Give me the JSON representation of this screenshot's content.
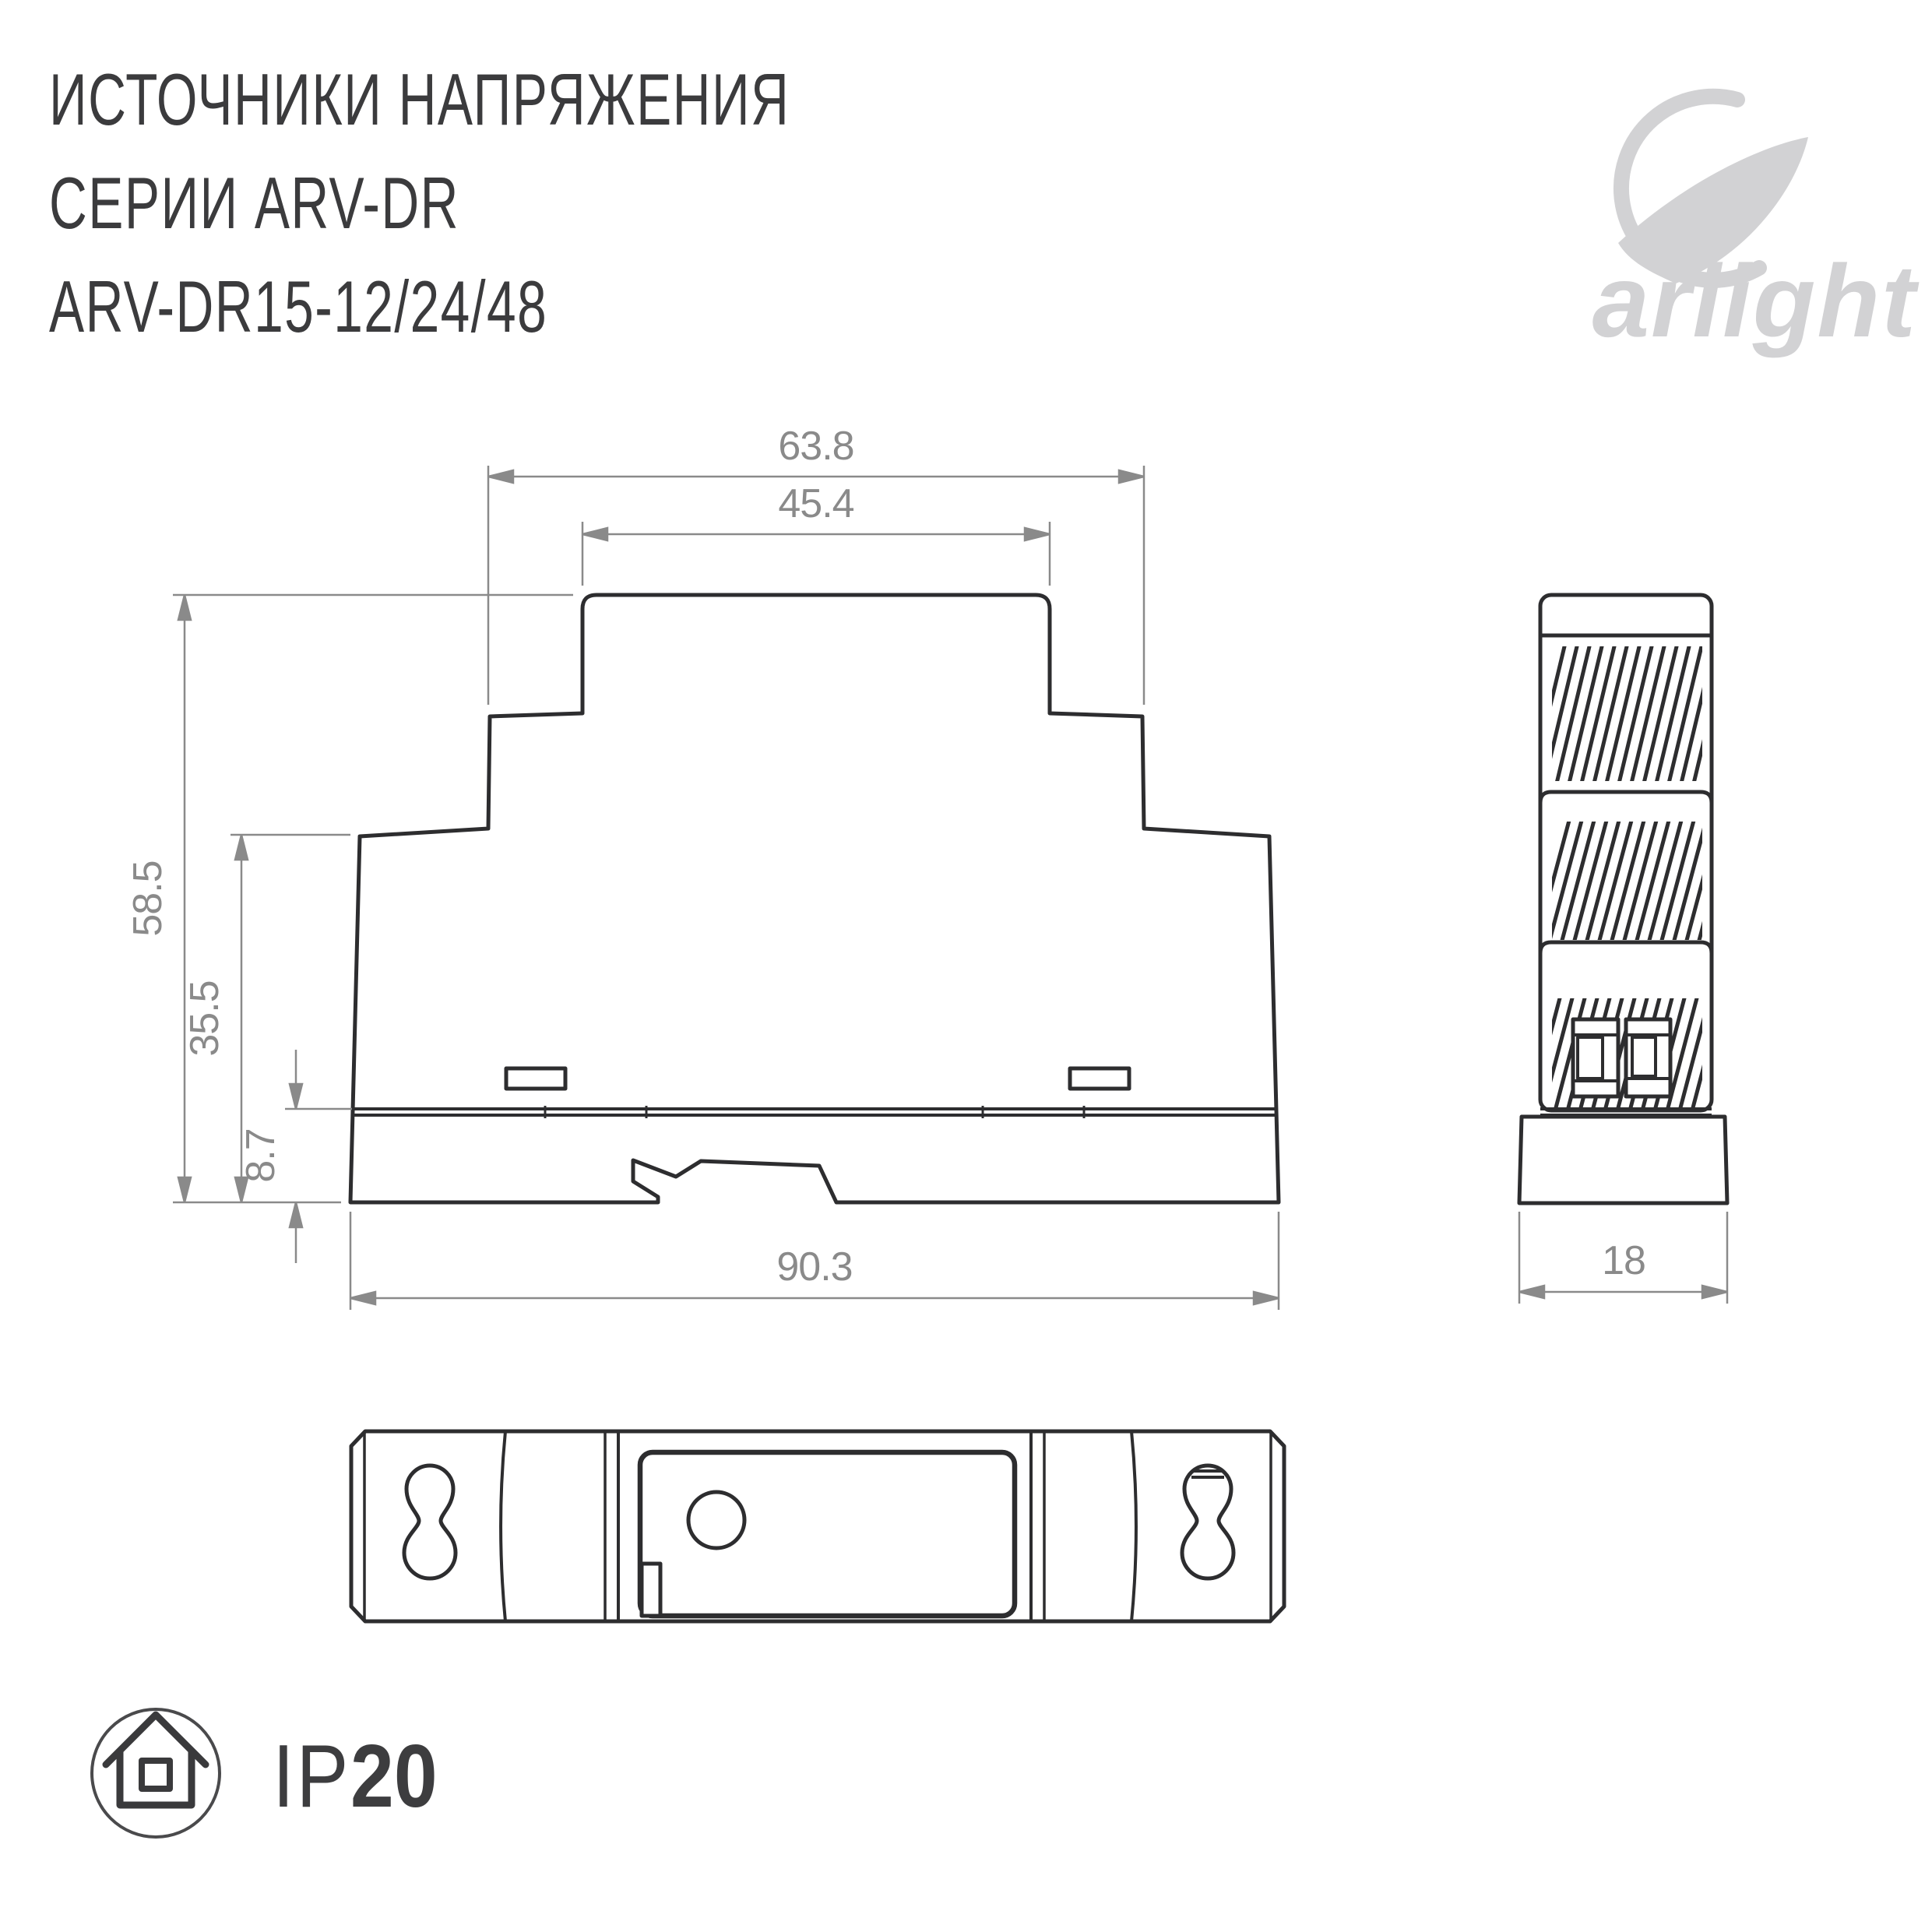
{
  "title": {
    "line1": "ИСТОЧНИКИ НАПРЯЖЕНИЯ",
    "line2": "СЕРИИ ARV-DR",
    "line3": "ARV-DR15-12/24/48"
  },
  "logo": {
    "text": "arlight",
    "color": "#d2d2d4"
  },
  "drawing": {
    "front_view": {
      "dim_top_outer": "63.8",
      "dim_top_inner": "45.4",
      "dim_height": "58.5",
      "dim_body_height": "35.5",
      "dim_rail_height": "8.7",
      "dim_width": "90.3"
    },
    "side_view": {
      "dim_width": "18"
    },
    "colors": {
      "outline": "#2d2d2f",
      "dimension": "#8a8a8a"
    }
  },
  "badge": {
    "prefix": "IP",
    "value": "20"
  }
}
